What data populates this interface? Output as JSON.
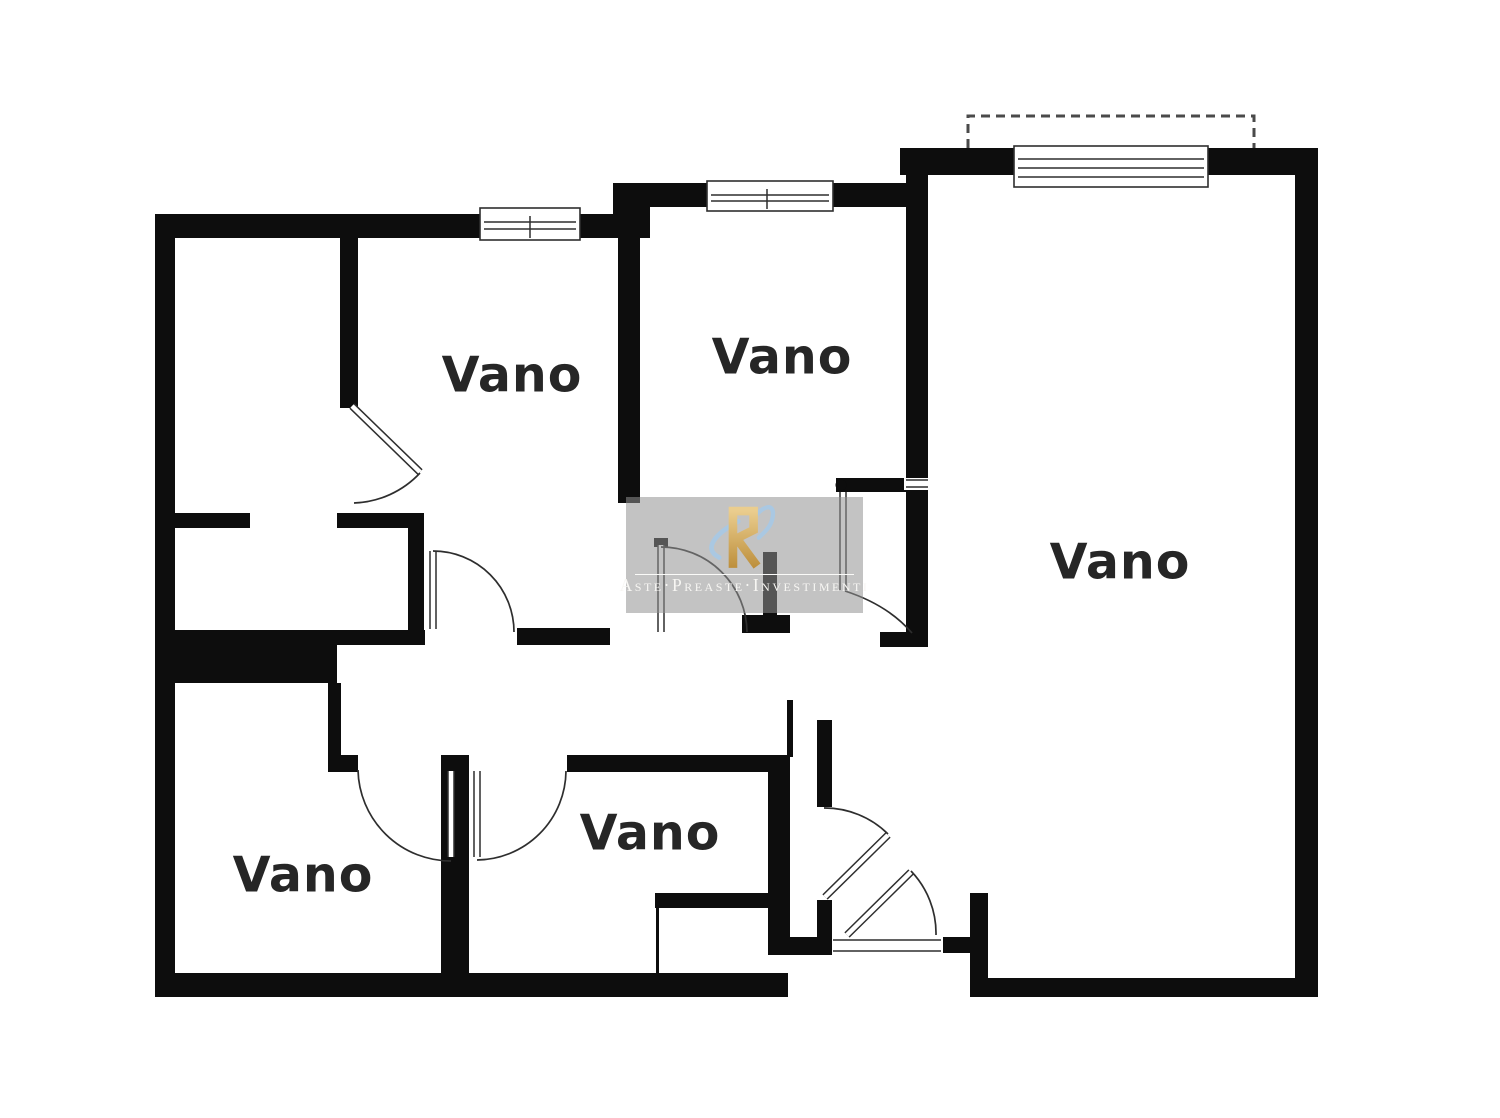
{
  "plan_title": "Planimetria",
  "colors": {
    "wall": "#0d0d0d",
    "line": "#2e2e2e",
    "label": "#262626",
    "watermark_bg": "rgba(146,146,146,0.55)",
    "watermark_text": "#f7f6f3",
    "logo_gold_light": "#eacd8e",
    "logo_gold_dark": "#bd8f3c",
    "logo_blue": "#a7c9e6"
  },
  "rooms": [
    {
      "id": "room-label-top-left",
      "label": "Vano",
      "cx": 512,
      "cy": 375
    },
    {
      "id": "room-label-top-middle",
      "label": "Vano",
      "cx": 782,
      "cy": 357
    },
    {
      "id": "room-label-right",
      "label": "Vano",
      "cx": 1120,
      "cy": 562
    },
    {
      "id": "room-label-bottom-middle",
      "label": "Vano",
      "cx": 650,
      "cy": 833
    },
    {
      "id": "room-label-bottom-left",
      "label": "Vano",
      "cx": 303,
      "cy": 875
    }
  ],
  "watermark": {
    "text": "Aste·Preaste·Investimenti",
    "logo_icon": "aste-preaste-logo-icon",
    "x": 626,
    "y": 497,
    "w": 237,
    "h": 116
  },
  "plan": {
    "walls": [
      {
        "name": "outer-wall-top-left",
        "x": 155,
        "y": 214,
        "w": 495,
        "h": 24
      },
      {
        "name": "outer-wall-jog-left",
        "x": 613,
        "y": 183,
        "w": 37,
        "h": 55
      },
      {
        "name": "outer-wall-top-middle",
        "x": 613,
        "y": 183,
        "w": 307,
        "h": 24
      },
      {
        "name": "outer-wall-top-right",
        "x": 900,
        "y": 148,
        "w": 418,
        "h": 27
      },
      {
        "name": "wall-between-middle-and-right-room",
        "x": 906,
        "y": 148,
        "w": 22,
        "h": 499
      },
      {
        "name": "outer-wall-right",
        "x": 1295,
        "y": 148,
        "w": 23,
        "h": 849
      },
      {
        "name": "outer-wall-bottom-right",
        "x": 970,
        "y": 978,
        "w": 348,
        "h": 19
      },
      {
        "name": "entry-step-vertical",
        "x": 970,
        "y": 893,
        "w": 18,
        "h": 104
      },
      {
        "name": "entry-step-horizontal",
        "x": 943,
        "y": 937,
        "w": 45,
        "h": 16
      },
      {
        "name": "threshold-left-wall",
        "x": 768,
        "y": 937,
        "w": 64,
        "h": 18
      },
      {
        "name": "outer-wall-bottom-left",
        "x": 155,
        "y": 973,
        "w": 633,
        "h": 24
      },
      {
        "name": "outer-wall-left",
        "x": 155,
        "y": 214,
        "w": 20,
        "h": 783
      },
      {
        "name": "wall-v1-top-left-rooms",
        "x": 340,
        "y": 238,
        "w": 18,
        "h": 170
      },
      {
        "name": "wall-h2-left",
        "x": 155,
        "y": 513,
        "w": 95,
        "h": 15
      },
      {
        "name": "wall-h2-right",
        "x": 337,
        "y": 513,
        "w": 83,
        "h": 15
      },
      {
        "name": "wall-v2-middle",
        "x": 618,
        "y": 207,
        "w": 22,
        "h": 296
      },
      {
        "name": "wall-h6-middle-room-bottom",
        "x": 836,
        "y": 478,
        "w": 80,
        "h": 14
      },
      {
        "name": "wall-corridor-top-thin",
        "x": 172,
        "y": 630,
        "w": 253,
        "h": 15
      },
      {
        "name": "wall-band-thick",
        "x": 155,
        "y": 645,
        "w": 182,
        "h": 38
      },
      {
        "name": "wall-v3-lower-left",
        "x": 328,
        "y": 683,
        "w": 13,
        "h": 80
      },
      {
        "name": "wall-h5-left-stub",
        "x": 328,
        "y": 755,
        "w": 30,
        "h": 17
      },
      {
        "name": "wall-v7-bottom-divider",
        "x": 441,
        "y": 755,
        "w": 28,
        "h": 220
      },
      {
        "name": "wall-h5-right",
        "x": 567,
        "y": 755,
        "w": 223,
        "h": 17
      },
      {
        "name": "wall-v8-hall-left",
        "x": 768,
        "y": 755,
        "w": 22,
        "h": 200
      },
      {
        "name": "wall-v8b-upper",
        "x": 817,
        "y": 720,
        "w": 15,
        "h": 87
      },
      {
        "name": "wall-v8b-lower",
        "x": 817,
        "y": 900,
        "w": 15,
        "h": 37
      },
      {
        "name": "wall-thin-connector",
        "x": 787,
        "y": 700,
        "w": 6,
        "h": 57
      },
      {
        "name": "wall-v4-corridor",
        "x": 408,
        "y": 513,
        "w": 16,
        "h": 120
      },
      {
        "name": "wall-h3-corridor-a",
        "x": 517,
        "y": 628,
        "w": 93,
        "h": 17
      },
      {
        "name": "wall-h3-corridor-b",
        "x": 742,
        "y": 615,
        "w": 48,
        "h": 18
      },
      {
        "name": "wall-v10-stub",
        "x": 763,
        "y": 552,
        "w": 14,
        "h": 65
      },
      {
        "name": "wall-h3-corridor-c",
        "x": 880,
        "y": 632,
        "w": 48,
        "h": 15
      },
      {
        "name": "cubicle-top-wall",
        "x": 655,
        "y": 893,
        "w": 135,
        "h": 15
      },
      {
        "name": "door-cap",
        "x": 654,
        "y": 538,
        "w": 14,
        "h": 9
      },
      {
        "name": "cubicle-left-line",
        "x": 656,
        "y": 908,
        "w": 3,
        "h": 66
      }
    ],
    "jamb_gaps": [
      {
        "name": "jamb-gap-v5",
        "x": 904,
        "y": 478,
        "w": 26,
        "h": 12,
        "lines": [
          [
            906,
            480,
            928,
            480
          ],
          [
            906,
            487,
            928,
            487
          ]
        ]
      }
    ],
    "windows": [
      {
        "name": "window-top-left",
        "x": 480,
        "y": 208,
        "w": 100,
        "h": 32,
        "lines": [
          222,
          229
        ],
        "divider": 530
      },
      {
        "name": "window-top-middle",
        "x": 707,
        "y": 181,
        "w": 126,
        "h": 30,
        "lines": [
          195,
          201
        ],
        "divider": 767
      },
      {
        "name": "window-top-right",
        "x": 1014,
        "y": 146,
        "w": 194,
        "h": 41,
        "lines": [
          159,
          168,
          177
        ],
        "divider": null
      }
    ],
    "balcony_dash_path": "M 968,148 L 968,116 L 1254,116 L 1254,148",
    "door_leaves": [
      {
        "name": "door-leaf-1",
        "x1": 352,
        "y1": 406,
        "x2": 420,
        "y2": 472
      },
      {
        "name": "door-leaf-2",
        "x1": 661,
        "y1": 545,
        "x2": 661,
        "y2": 632
      },
      {
        "name": "door-leaf-3",
        "x1": 433,
        "y1": 551,
        "x2": 433,
        "y2": 629
      },
      {
        "name": "door-leaf-4",
        "x1": 451,
        "y1": 771,
        "x2": 451,
        "y2": 857
      },
      {
        "name": "door-leaf-5",
        "x1": 477,
        "y1": 771,
        "x2": 477,
        "y2": 857
      },
      {
        "name": "door-leaf-6",
        "x1": 825,
        "y1": 897,
        "x2": 888,
        "y2": 835
      },
      {
        "name": "door-leaf-7",
        "x1": 847,
        "y1": 935,
        "x2": 911,
        "y2": 872
      },
      {
        "name": "door-leaf-8",
        "x1": 843,
        "y1": 492,
        "x2": 843,
        "y2": 590
      }
    ],
    "door_arcs": [
      {
        "name": "door-arc-1",
        "d": "M 420,473 A 95 95 0 0 1 354,503"
      },
      {
        "name": "door-arc-2",
        "d": "M 661,547 A 86 86 0 0 1 747,632"
      },
      {
        "name": "door-arc-3",
        "d": "M 433,551 A 81 81 0 0 1 514,632"
      },
      {
        "name": "door-arc-4",
        "d": "M 358,770 A 93 93 0 0 0 451,861"
      },
      {
        "name": "door-arc-5",
        "d": "M 477,860 A 90 90 0 0 0 566,771"
      },
      {
        "name": "door-arc-6",
        "d": "M 824,808 A 90 90 0 0 1 888,834"
      },
      {
        "name": "door-arc-7",
        "d": "M 936,935 A 90 90 0 0 0 911,871"
      },
      {
        "name": "door-arc-8",
        "d": "M 845,591 Q 888,605 912,633"
      }
    ],
    "hinge_dot": {
      "cx": 841,
      "cy": 485,
      "r": 5.5
    },
    "threshold_lines": [
      [
        833,
        940,
        941,
        940
      ],
      [
        833,
        951,
        941,
        951
      ]
    ]
  }
}
